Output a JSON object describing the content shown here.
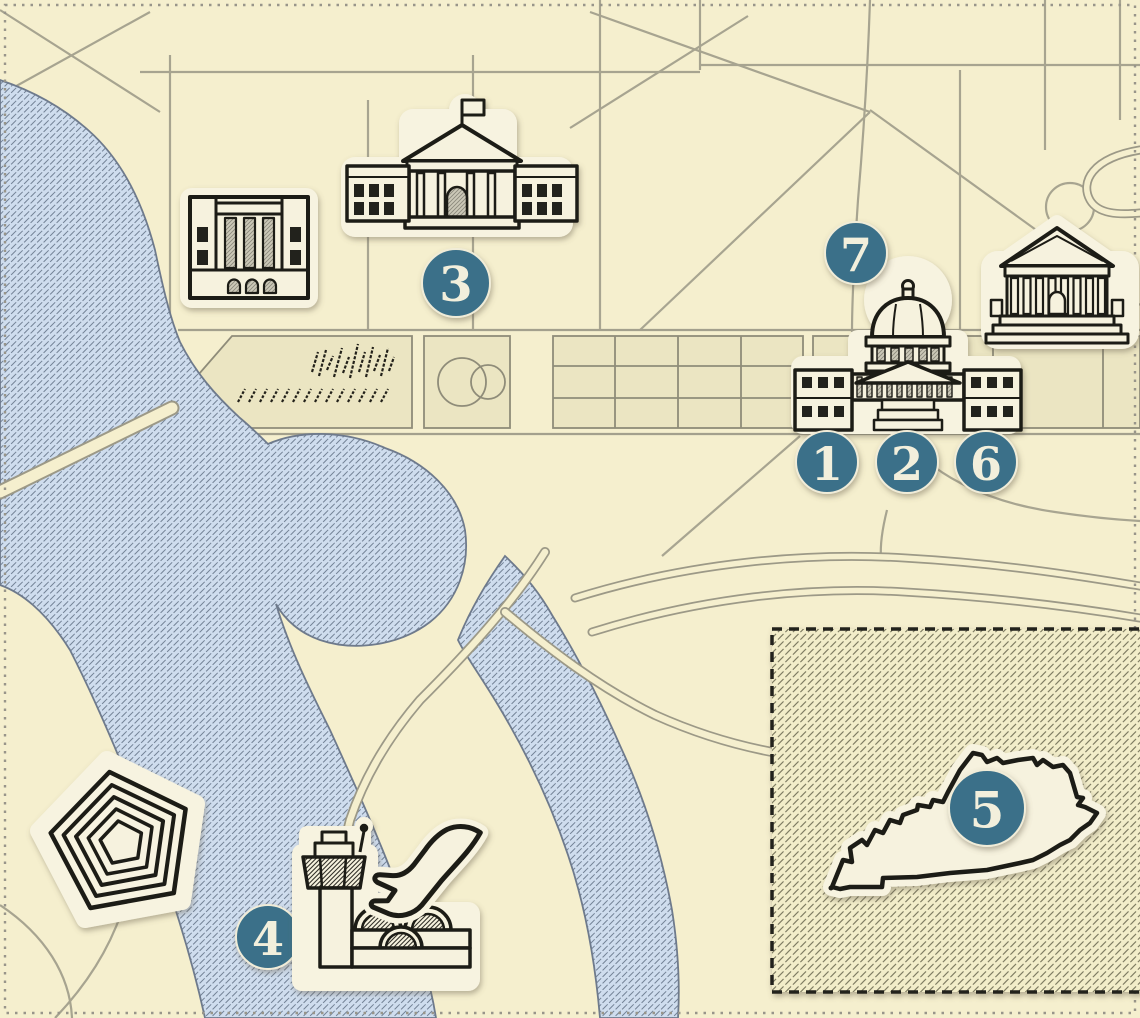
{
  "markers": [
    {
      "id": "1",
      "label": "1"
    },
    {
      "id": "2",
      "label": "2"
    },
    {
      "id": "3",
      "label": "3"
    },
    {
      "id": "4",
      "label": "4"
    },
    {
      "id": "5",
      "label": "5"
    },
    {
      "id": "6",
      "label": "6"
    },
    {
      "id": "7",
      "label": "7"
    }
  ],
  "icons": [
    "white-house-icon",
    "government-building-icon",
    "us-capitol-icon",
    "supreme-court-icon",
    "pentagon-icon",
    "airport-tower-icon",
    "airplane-icon",
    "kentucky-state-icon",
    "washington-monument-sketch"
  ],
  "colors": {
    "background": "#f5efce",
    "panel": "#ebe5c2",
    "road": "#a3a08d",
    "water": "#cfddee",
    "water_line": "#5c6b80",
    "ink": "#1d1b15",
    "sticker": "#f7f3e0",
    "marker": "#3b7089",
    "marker_text": "#f2efdc",
    "inset_hatch": "#807d63"
  }
}
